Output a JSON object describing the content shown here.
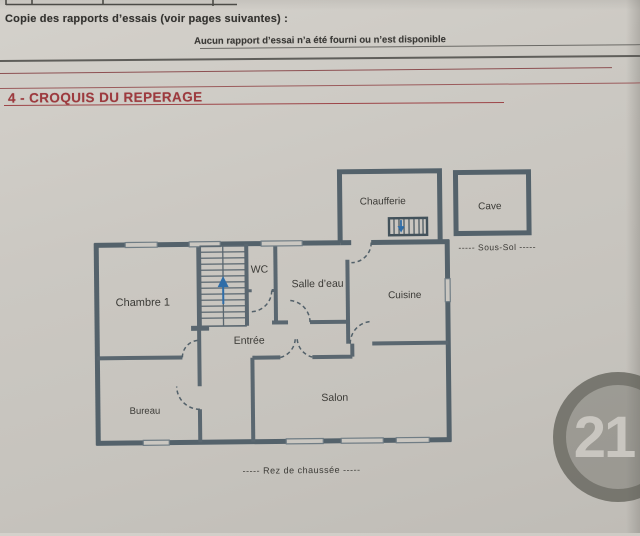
{
  "document": {
    "intro_line": "Copie des rapports d’essais (voir pages suivantes) :",
    "no_report_notice": "Aucun rapport d’essai n’a été fourni ou n’est disponible",
    "section_heading": "4 - CROQUIS DU REPERAGE"
  },
  "floorplan": {
    "rooms": {
      "chaufferie": "Chaufferie",
      "cave": "Cave",
      "chambre1": "Chambre 1",
      "wc": "WC",
      "salle_deau": "Salle d’eau",
      "cuisine": "Cuisine",
      "entree": "Entrée",
      "bureau": "Bureau",
      "salon": "Salon"
    },
    "levels": {
      "sous_sol": "-----  Sous-Sol  -----",
      "rez_de_chaussee": "-----  Rez de chaussée  -----"
    }
  },
  "watermark": {
    "number": "21"
  },
  "colors": {
    "wall": "#54626b",
    "heading_red": "#9d3a3e",
    "arrow_blue": "#2f6da8",
    "paper": "#cac7c1",
    "ink": "#3a3936"
  }
}
